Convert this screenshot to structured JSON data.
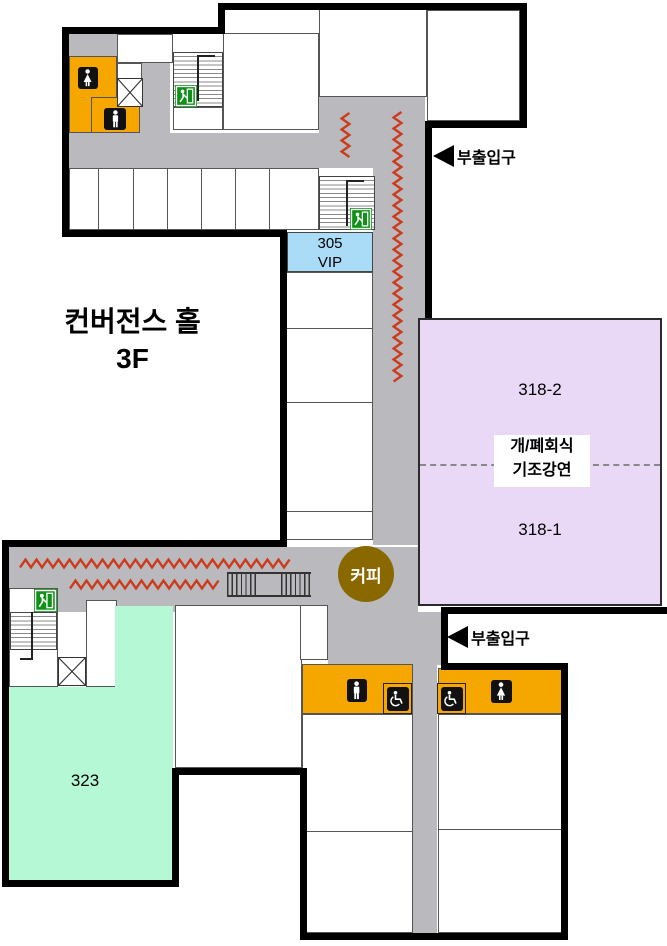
{
  "floor_map": {
    "title": {
      "line1": "컨버전스 홀",
      "line2": "3F"
    },
    "rooms": {
      "vip_number": "305",
      "vip_name": "VIP",
      "hall_318_2": "318-2",
      "hall_318_1": "318-1",
      "hall_318_event_line1": "개/폐회식",
      "hall_318_event_line2": "기조강연",
      "room_323": "323"
    },
    "labels": {
      "sub_entrance": "부출입구",
      "coffee": "커피"
    },
    "icons": {
      "exit": "exit-sign",
      "male_restroom": "male-restroom",
      "female_restroom": "female-restroom",
      "accessible_restroom": "wheelchair-accessible-restroom",
      "elevator": "elevator",
      "stairs": "stairs",
      "escalator": "escalator",
      "entrance_arrow": "left-arrow"
    },
    "colors": {
      "corridor_gray": "#b9b9be",
      "wall_black": "#000000",
      "restroom_orange": "#f5a700",
      "vip_blue": "#aadcf7",
      "hall_purple": "#e9d9f6",
      "room_green": "#b4f8d6",
      "coffee_brown": "#8a6800",
      "exit_green": "#0f9018",
      "zigzag_red": "#cc3b1c"
    }
  }
}
